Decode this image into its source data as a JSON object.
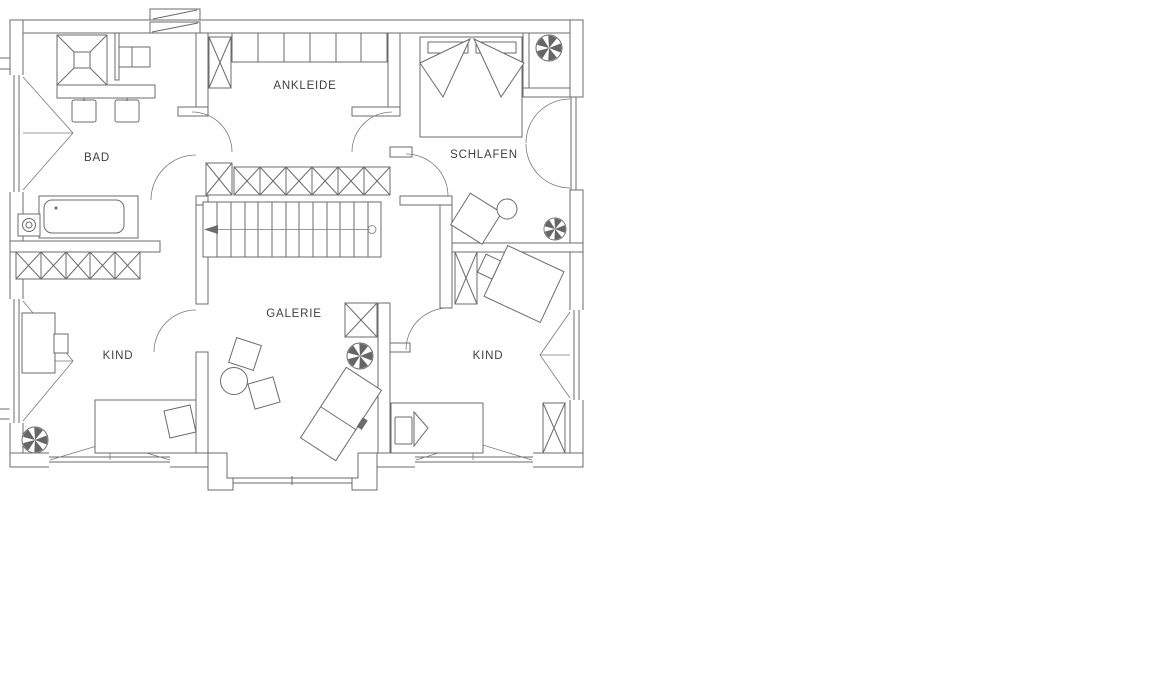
{
  "plan": {
    "type": "floor-plan",
    "language": "de",
    "wall_color": "#6b6b6b",
    "text_color": "#3f3f3f",
    "background": "#ffffff",
    "rooms": [
      {
        "id": "bad",
        "label": "BAD",
        "furniture": [
          "shower",
          "double-washbasin",
          "bathtub",
          "wc"
        ]
      },
      {
        "id": "ankleide",
        "label": "ANKLEIDE",
        "furniture": [
          "wardrobe-row",
          "dresser-row"
        ]
      },
      {
        "id": "schlafen",
        "label": "SCHLAFEN",
        "furniture": [
          "double-bed",
          "chair",
          "round-table",
          "french-balcony-doors"
        ]
      },
      {
        "id": "galerie",
        "label": "GALERIE",
        "furniture": [
          "staircase",
          "two-chairs",
          "round-table",
          "lounger",
          "shaft"
        ]
      },
      {
        "id": "kind-left",
        "label": "KIND",
        "furniture": [
          "wardrobe-row",
          "desk",
          "chair",
          "bed"
        ]
      },
      {
        "id": "kind-right",
        "label": "KIND",
        "furniture": [
          "desk",
          "chair",
          "bed",
          "wardrobe",
          "shaft"
        ]
      }
    ],
    "symbols": {
      "fan_icons": 4,
      "stair_arrow_direction": "left",
      "window_triangles": 5,
      "x_hatched_cabinets": 7
    }
  }
}
